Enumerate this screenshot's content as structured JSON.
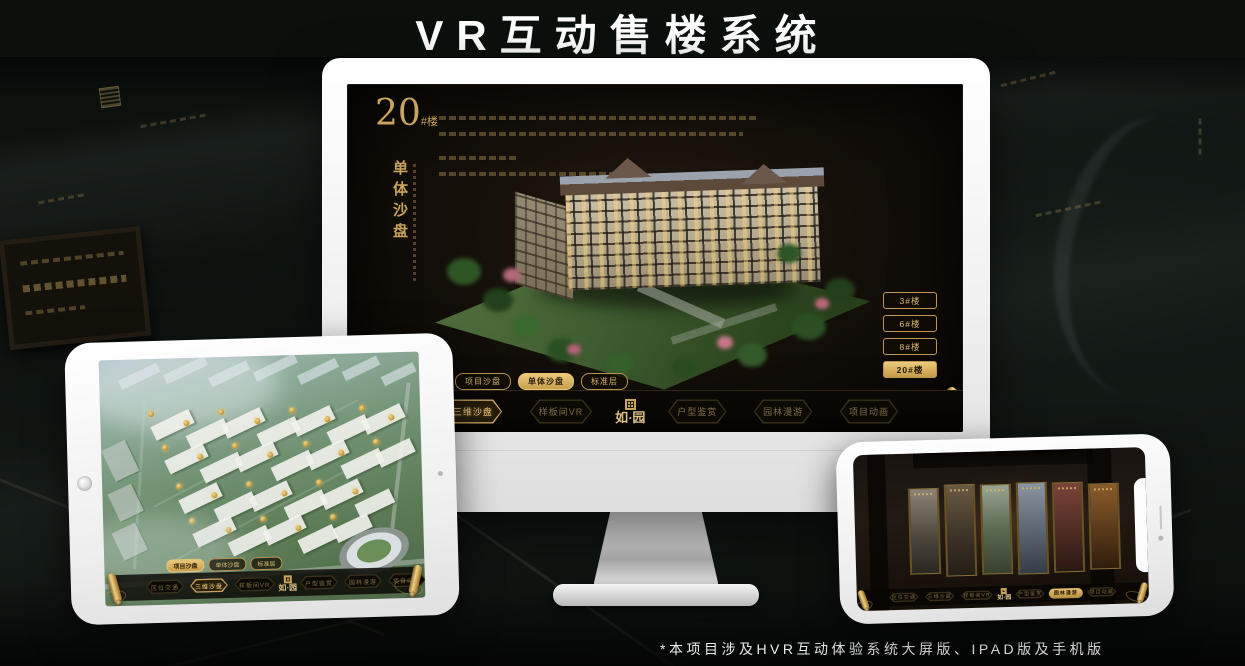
{
  "title": "VR互动售楼系统",
  "footnote": "*本项目涉及HVR互动体验系统大屏版、IPAD版及手机版",
  "colors": {
    "gold": "#c9a45c",
    "gold_bright": "#e8c878",
    "screen_bg": "#140f09"
  },
  "app": {
    "logo_text": "如·园",
    "nav_items": [
      "区位交通",
      "三维沙盘",
      "样板间VR",
      "户型鉴赏",
      "园林漫游",
      "项目动画"
    ],
    "view_tabs": [
      "项目沙盘",
      "单体沙盘",
      "标准层"
    ]
  },
  "monitor": {
    "block_number": "20",
    "block_unit": "#楼",
    "block_subtitle": "单体沙盘",
    "floor_buttons": [
      "3#楼",
      "6#楼",
      "8#楼",
      "20#楼"
    ],
    "active_floor": "20#楼",
    "active_tab": "单体沙盘",
    "active_nav": "三维沙盘"
  },
  "ipad": {
    "active_tab": "项目沙盘",
    "active_nav": "三维沙盘"
  },
  "phone": {
    "active_nav": "园林漫游"
  }
}
